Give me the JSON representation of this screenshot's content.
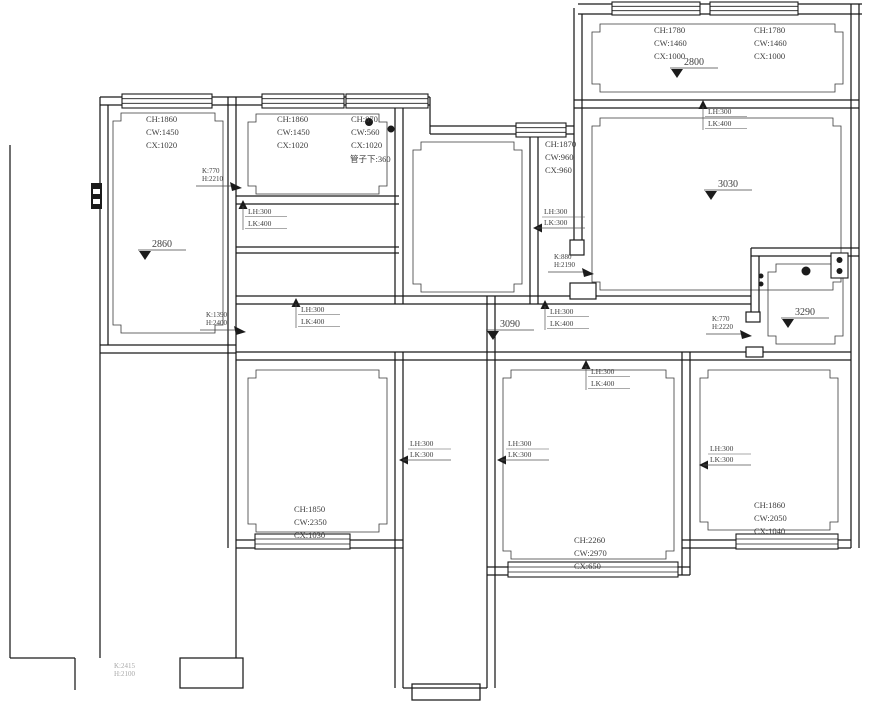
{
  "colors": {
    "wall": "#1b1b1b",
    "text": "#3d3d3d",
    "muted": "#a8a8a8",
    "background": "#ffffff"
  },
  "window_labels": [
    {
      "x": 146,
      "y": 122,
      "lines": [
        "CH:1860",
        "CW:1450",
        "CX:1020"
      ]
    },
    {
      "x": 277,
      "y": 122,
      "lines": [
        "CH:1860",
        "CW:1450",
        "CX:1020"
      ]
    },
    {
      "x": 351,
      "y": 122,
      "lines": [
        "CH:870",
        "CW:560",
        "CX:1020"
      ]
    },
    {
      "x": 545,
      "y": 147,
      "lines": [
        "CH:1870",
        "CW:960",
        "CX:960"
      ]
    },
    {
      "x": 654,
      "y": 33,
      "lines": [
        "CH:1780",
        "CW:1460",
        "CX:1000"
      ]
    },
    {
      "x": 754,
      "y": 33,
      "lines": [
        "CH:1780",
        "CW:1460",
        "CX:1000"
      ]
    },
    {
      "x": 294,
      "y": 512,
      "lines": [
        "CH:1850",
        "CW:2350",
        "CX:1030"
      ]
    },
    {
      "x": 574,
      "y": 543,
      "lines": [
        "CH:2260",
        "CW:2970",
        "CX:650"
      ]
    },
    {
      "x": 754,
      "y": 508,
      "lines": [
        "CH:1860",
        "CW:2050",
        "CX:1040"
      ]
    }
  ],
  "beam_labels": [
    {
      "lines": [
        "LH:300",
        "LK:400"
      ],
      "dir": "up",
      "ax": 243,
      "ay": 200
    },
    {
      "lines": [
        "LH:300",
        "LK:400"
      ],
      "dir": "up",
      "ax": 296,
      "ay": 298
    },
    {
      "lines": [
        "LH:300",
        "LK:300"
      ],
      "dir": "left",
      "ax": 533,
      "ay": 228
    },
    {
      "lines": [
        "LH:300",
        "LK:400"
      ],
      "dir": "up",
      "ax": 545,
      "ay": 300
    },
    {
      "lines": [
        "LH:300",
        "LK:400"
      ],
      "dir": "up",
      "ax": 703,
      "ay": 100
    },
    {
      "lines": [
        "LH:300",
        "LK:400"
      ],
      "dir": "up",
      "ax": 586,
      "ay": 360
    },
    {
      "lines": [
        "LH:300",
        "LK:300"
      ],
      "dir": "left",
      "ax": 399,
      "ay": 460
    },
    {
      "lines": [
        "LH:300",
        "LK:300"
      ],
      "dir": "left",
      "ax": 497,
      "ay": 460
    },
    {
      "lines": [
        "LH:300",
        "LK:300"
      ],
      "dir": "left",
      "ax": 699,
      "ay": 465
    }
  ],
  "door_labels": [
    {
      "lines": [
        "K:770",
        "H:2210"
      ],
      "x1": 196,
      "y1": 186,
      "x2": 233
    },
    {
      "lines": [
        "K:1390",
        "H:2400"
      ],
      "x1": 200,
      "y1": 330,
      "x2": 237
    },
    {
      "lines": [
        "K:880",
        "H:2190"
      ],
      "x1": 548,
      "y1": 272,
      "x2": 585
    },
    {
      "lines": [
        "K:770",
        "H:2220"
      ],
      "x1": 706,
      "y1": 334,
      "x2": 743
    },
    {
      "lines": [
        "K:2415",
        "H:2100"
      ],
      "x1": 108,
      "y1": 681,
      "muted": true
    }
  ],
  "elevation_markers": [
    {
      "value": "2860",
      "x": 152,
      "y": 247
    },
    {
      "value": "2800",
      "x": 684,
      "y": 65
    },
    {
      "value": "3030",
      "x": 718,
      "y": 187
    },
    {
      "value": "3090",
      "x": 500,
      "y": 327
    },
    {
      "value": "3290",
      "x": 795,
      "y": 315
    }
  ],
  "notes": [
    {
      "text": "管子下:360",
      "x": 350,
      "y": 162
    }
  ],
  "symbols": [
    {
      "name": "socket-double-box",
      "type": "socket2",
      "x": 831,
      "y": 253
    },
    {
      "name": "ceiling-light-dot",
      "type": "dot",
      "x": 806,
      "y": 271,
      "r": 4.5
    },
    {
      "name": "wall-socket-dot",
      "type": "dot",
      "x": 761,
      "y": 276,
      "r": 2.5
    },
    {
      "name": "wall-socket-dot",
      "type": "dot",
      "x": 761,
      "y": 284,
      "r": 2.5
    },
    {
      "name": "electrical-panel",
      "type": "panel",
      "x": 91,
      "y": 183
    },
    {
      "name": "label-dot",
      "type": "dot",
      "x": 369,
      "y": 122,
      "r": 4
    },
    {
      "name": "label-dot",
      "type": "dot",
      "x": 391,
      "y": 129,
      "r": 3.5
    }
  ]
}
